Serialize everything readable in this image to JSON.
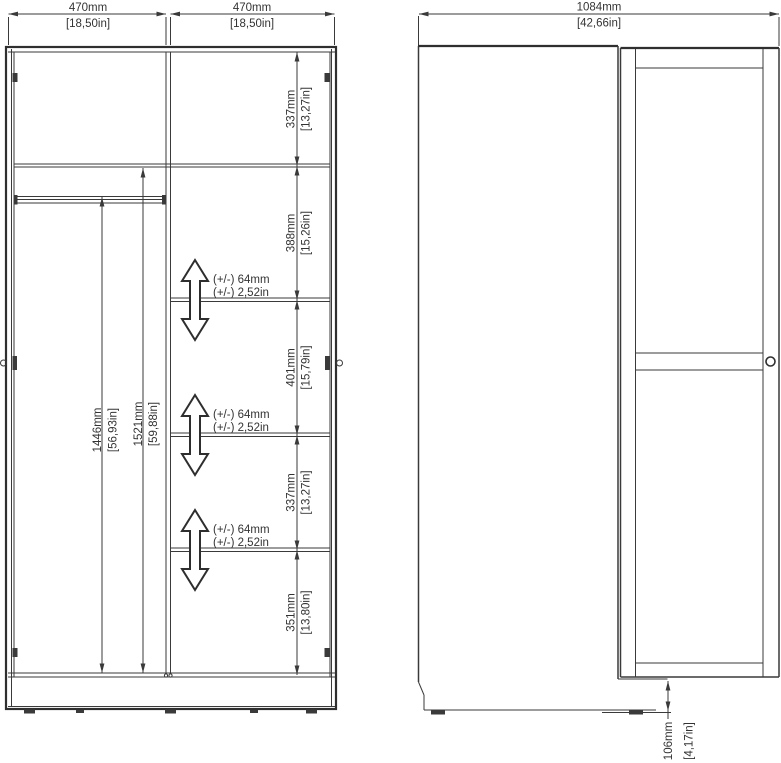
{
  "drawing_colors": {
    "line": "#3a3a3a",
    "text": "#333333",
    "background": "#ffffff"
  },
  "front_view": {
    "door_width_left": {
      "mm": "470mm",
      "inch": "[18,50in]"
    },
    "door_width_right": {
      "mm": "470mm",
      "inch": "[18,50in]"
    },
    "height_segments": [
      {
        "mm": "337mm",
        "inch": "[13,27in]"
      },
      {
        "mm": "388mm",
        "inch": "[15,26in]"
      },
      {
        "mm": "401mm",
        "inch": "[15,79in]"
      },
      {
        "mm": "337mm",
        "inch": "[13,27in]"
      },
      {
        "mm": "351mm",
        "inch": "[13,80in]"
      }
    ],
    "hanging_space": {
      "mm": "1446mm",
      "inch": "[56,93in]"
    },
    "interior_height": {
      "mm": "1521mm",
      "inch": "[59,88in]"
    },
    "shelf_adjustability": {
      "mm": "(+/-) 64mm",
      "inch": "(+/-) 2,52in"
    }
  },
  "side_view": {
    "depth_door_open": {
      "mm": "1084mm",
      "inch": "[42,66in]"
    },
    "floor_clearance": {
      "mm": "106mm",
      "inch": "[4,17in]"
    }
  }
}
